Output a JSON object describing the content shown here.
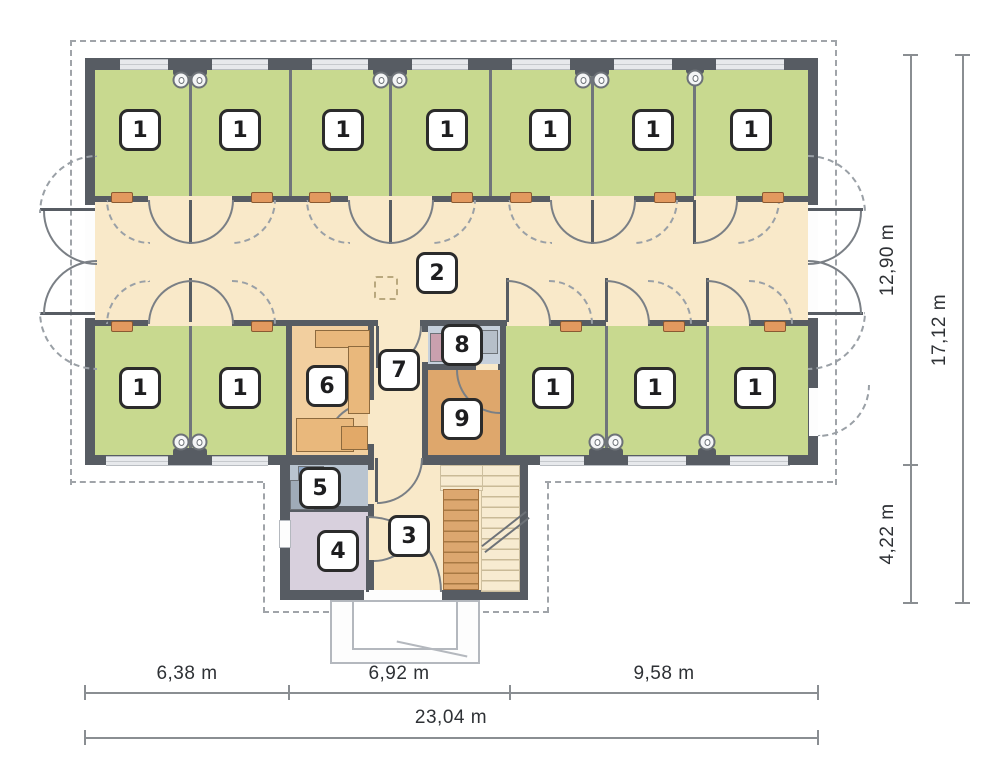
{
  "title": "Ground floor plan",
  "room_labels": {
    "bedroom": "1",
    "corridor": "2",
    "hall": "3",
    "room4": "4",
    "room5": "5",
    "room6": "6",
    "room7": "7",
    "room8": "8",
    "room9": "9"
  },
  "dimensions": {
    "bottom_segments": [
      "6,38 m",
      "6,92 m",
      "9,58 m"
    ],
    "bottom_total": "23,04 m",
    "right_segments": [
      "12,90 m",
      "4,22 m"
    ],
    "right_total": "17,12 m"
  },
  "colors": {
    "wall": "#575c63",
    "partition": "#70757b",
    "arc": "#7a7f85",
    "room_green": "#c8d98f",
    "corridor_beige": "#f9e9c9",
    "room_peach": "#f2cf9f",
    "room_orange": "#dea76c",
    "room_lavender": "#d8d0dd",
    "room_grayblue": "#b9c4d0",
    "room_paleblue": "#c6d0dc",
    "furniture_tan": "#e9b87c",
    "threshold_orange": "#e2995f",
    "stair_orange": "#dca76f",
    "stair_beige": "#f7ebd1",
    "window_light": "#e7e9ec",
    "outline_dash": "#a0a4a9",
    "dim_line": "#8a8e92",
    "dim_text": "#2e3135",
    "badge_border": "#2b2b2b"
  }
}
